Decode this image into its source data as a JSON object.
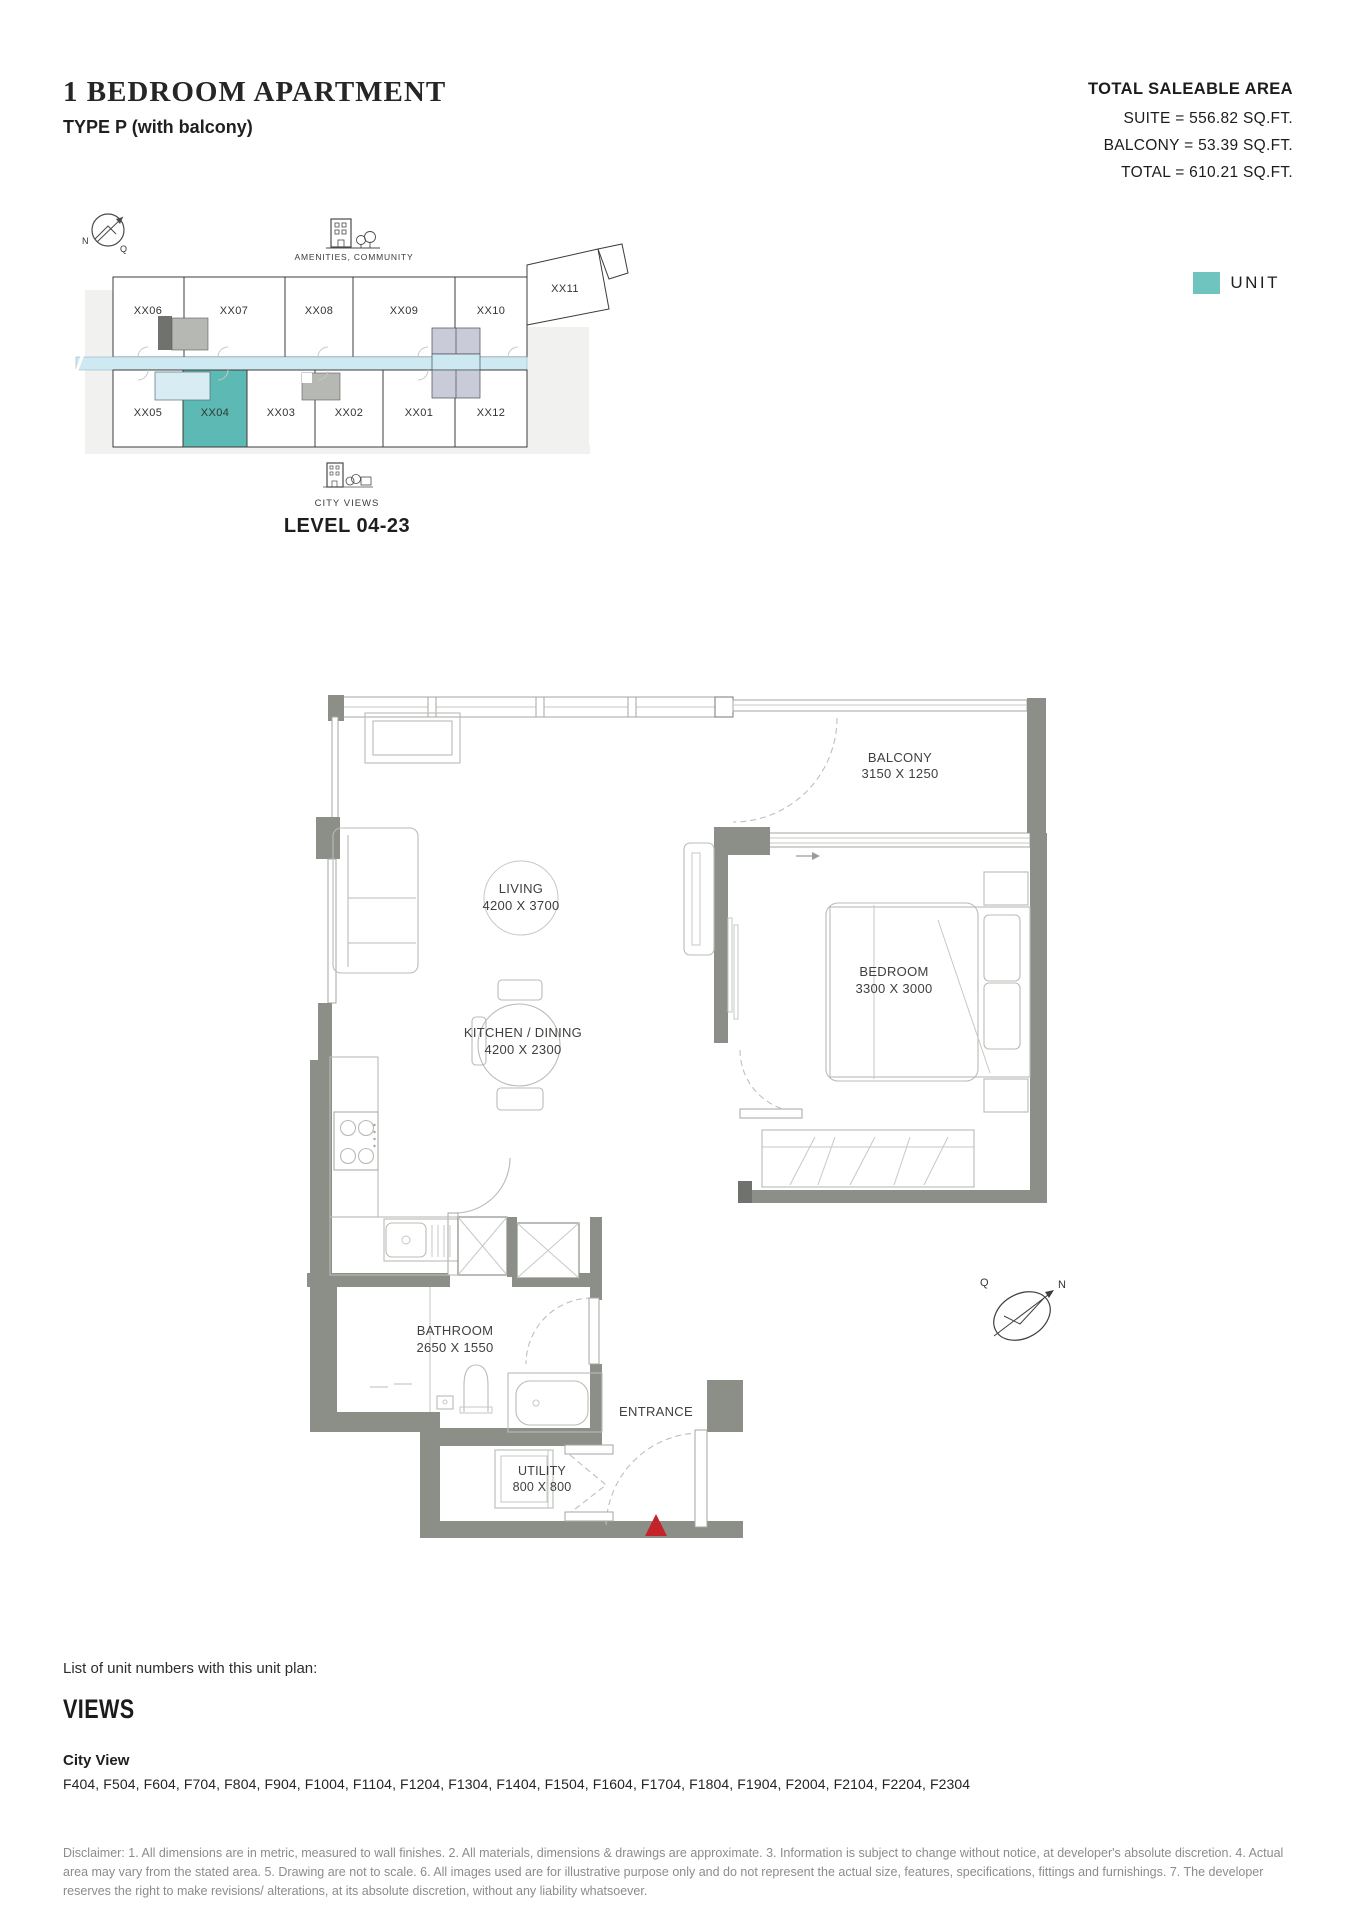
{
  "header": {
    "title": "1 BEDROOM APARTMENT",
    "subtitle": "TYPE P (with balcony)",
    "area": {
      "heading": "TOTAL SALEABLE AREA",
      "lines": [
        "SUITE = 556.82 SQ.FT.",
        "BALCONY = 53.39 SQ.FT.",
        "TOTAL = 610.21 SQ.FT."
      ]
    }
  },
  "legend": {
    "unit_label": "UNIT",
    "unit_color": "#6fc4bf"
  },
  "key_plan": {
    "amenities_label": "AMENITIES, COMMUNITY",
    "city_views_label": "CITY VIEWS",
    "level_label": "LEVEL 04-23",
    "top_row": [
      "XX06",
      "XX07",
      "XX08",
      "XX09",
      "XX10"
    ],
    "annex_unit": "XX11",
    "bottom_row": [
      "XX05",
      "XX04",
      "XX03",
      "XX02",
      "XX01",
      "XX12"
    ],
    "highlighted_unit": "XX04",
    "compass": {
      "n": "N",
      "q": "Q"
    }
  },
  "floor_plan": {
    "rooms": [
      {
        "name": "BALCONY",
        "dims": "3150 X 1250"
      },
      {
        "name": "LIVING",
        "dims": "4200 X 3700"
      },
      {
        "name": "KITCHEN / DINING",
        "dims": "4200 X 2300"
      },
      {
        "name": "BEDROOM",
        "dims": "3300 X 3000"
      },
      {
        "name": "BATHROOM",
        "dims": "2650 X 1550"
      },
      {
        "name": "UTILITY",
        "dims": "800 X 800"
      },
      {
        "name": "ENTRANCE",
        "dims": ""
      }
    ],
    "entrance_marker_color": "#c5232a",
    "wall_color": "#8b8f88",
    "corridor_color": "#cfe9f2",
    "highlight_color": "#5cb9b3"
  },
  "icons": {
    "amenities_icon": "building-with-trees",
    "city_views_icon": "city-buildings",
    "compass_icon": "compass-north-arrow",
    "entrance_marker": "red-triangle"
  },
  "footer": {
    "list_intro": "List of unit numbers with this unit plan:",
    "views_heading": "VIEWS",
    "view_type": "City View",
    "units": "F404, F504, F604, F704, F804, F904, F1004, F1104, F1204, F1304, F1404, F1504, F1604, F1704, F1804, F1904, F2004, F2104, F2204, F2304",
    "disclaimer": "Disclaimer: 1. All dimensions are in metric, measured to wall finishes. 2. All materials, dimensions & drawings are approximate. 3. Information is subject to change without notice, at developer's absolute discretion. 4. Actual area may vary from the stated area. 5. Drawing are not to scale. 6. All images used are for illustrative purpose only and do not represent the actual size, features, specifications, fittings and furnishings. 7. The developer reserves the right to make revisions/ alterations, at its absolute discretion, without any liability whatsoever."
  }
}
